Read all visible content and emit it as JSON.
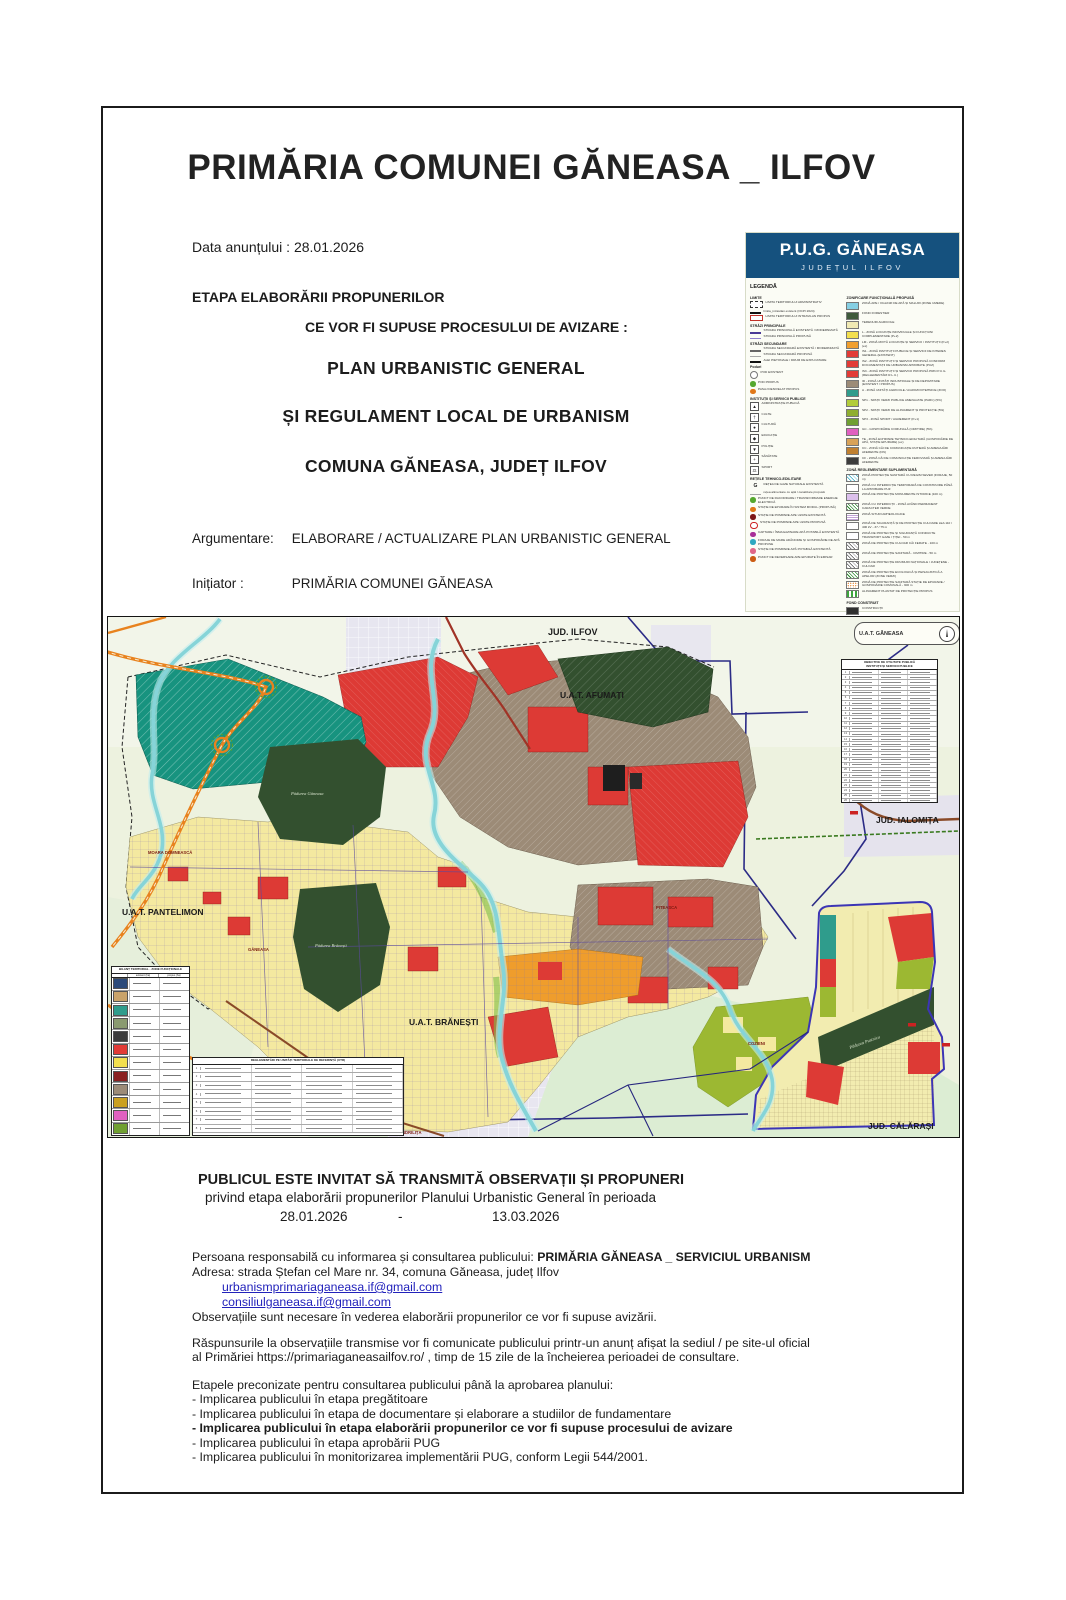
{
  "header": {
    "title": "PRIMĂRIA COMUNEI GĂNEASA _ ILFOV",
    "date_line": "Data anunțului : 28.01.2026",
    "stage_line1": "ETAPA ELABORĂRII PROPUNERILOR",
    "stage_line2": "CE VOR FI SUPUSE PROCESULUI DE AVIZARE :",
    "doc_title1": "PLAN URBANISTIC GENERAL",
    "doc_title2": "ȘI REGULAMENT LOCAL DE URBANISM",
    "doc_title3": "COMUNA GĂNEASA, JUDEȚ ILFOV",
    "argument_label": "Argumentare:",
    "argument_value": "ELABORARE / ACTUALIZARE PLAN URBANISTIC GENERAL",
    "initiator_label": "Inițiator :",
    "initiator_value": "PRIMĂRIA COMUNEI GĂNEASA"
  },
  "legend_panel": {
    "title": "P.U.G. GĂNEASA",
    "subtitle": "JUDEȚUL ILFOV",
    "heading": "LEGENDĂ",
    "header_color": "#15517e",
    "left_items": [
      {
        "h": "LIMITE"
      },
      {
        "sym": "dashbox",
        "glyph": "",
        "label": "LIMITA TERITORIULUI ADMINISTRATIV"
      },
      {
        "sym": "lineblack",
        "glyph": "",
        "label": "limita_intravilan existent (OCPI 2024)"
      },
      {
        "sym": "redbox",
        "glyph": "",
        "label": "LIMITA TERITORIULUI INTRAVILAN PROPUS"
      },
      {
        "h": "STRĂZI PRINCIPALE"
      },
      {
        "sym": "linepurple",
        "glyph": "",
        "label": "STRADA PRINCIPALĂ EXISTENTĂ / MODERNIZATĂ"
      },
      {
        "sym": "linepurple2",
        "glyph": "",
        "label": "STRADA PRINCIPALĂ PROPUSĂ"
      },
      {
        "h": "STRĂZI SECUNDARE"
      },
      {
        "sym": "linegray",
        "glyph": "",
        "label": "STRADA SECUNDARĂ EXISTENTĂ / MODERNIZATĂ"
      },
      {
        "sym": "linegray2",
        "glyph": "",
        "label": "STRADA SECUNDARĂ PROPUSĂ"
      },
      {
        "sym": "lineblack",
        "glyph": "",
        "label": "ALEI PIETONALE / DRUM DE EXPLOATARE"
      },
      {
        "h": "Poduri"
      },
      {
        "sym": "ringgray",
        "glyph": "",
        "label": "POD EXISTENT"
      },
      {
        "sym": "dgreen",
        "glyph": "",
        "label": "POD PROPUS"
      },
      {
        "sym": "dorange",
        "glyph": "",
        "label": "PASAJ DENIVELAT PROPUS"
      },
      {
        "h": "INSTITUȚII ȘI SERVICII PUBLICE"
      },
      {
        "sym": "symbox",
        "glyph": "▲",
        "label": "ADMINISTRAȚIE PUBLICĂ"
      },
      {
        "sym": "symbox",
        "glyph": "†",
        "label": "CULTE"
      },
      {
        "sym": "symbox",
        "glyph": "●",
        "label": "CULTURĂ"
      },
      {
        "sym": "symbox",
        "glyph": "◆",
        "label": "EDUCAȚIE"
      },
      {
        "sym": "symbox",
        "glyph": "▼",
        "label": "POLIȚIE"
      },
      {
        "sym": "symbox",
        "glyph": "+",
        "label": "SĂNĂTATE"
      },
      {
        "sym": "symbox",
        "glyph": "⚖",
        "label": "SPORT"
      },
      {
        "h": "REȚELE TEHNICO-EDILITARE"
      },
      {
        "sym": "gsym",
        "glyph": "G",
        "label": "REȚEA DE GAZE NATURALE EXISTENTĂ"
      },
      {
        "sym": "linegray2",
        "glyph": "",
        "label": "rețea alimentare cu apă / canalizare propusă"
      },
      {
        "sym": "dgreen",
        "glyph": "",
        "label": "PUNCT DE RACORDARE / TRANSFORMARE ENERGIE ELECTRICĂ"
      },
      {
        "sym": "dorange",
        "glyph": "",
        "label": "STAȚIE DE EPURARE ÎN SISTEM MODUL (PROPUSĂ)"
      },
      {
        "sym": "ddarkred",
        "glyph": "",
        "label": "STAȚIE DE POMPARE APE UZATE EXISTENTĂ"
      },
      {
        "sym": "dringred",
        "glyph": "",
        "label": "STAȚIE DE POMPARE APE UZATE PROPUSĂ"
      },
      {
        "sym": "dmagenta",
        "glyph": "",
        "label": "CAPTARE / ÎNMAGAZINARE APĂ POTABILĂ EXISTENTĂ"
      },
      {
        "sym": "dcyan",
        "glyph": "",
        "label": "FORAJE DE MARE ADÂNCIME ȘI GOSPODĂRIE DE APĂ PROPUSE"
      },
      {
        "sym": "dpink",
        "glyph": "",
        "label": "STAȚIE DE POMPARE APĂ POTABILĂ EXISTENTĂ"
      },
      {
        "sym": "dorange2",
        "glyph": "",
        "label": "PUNCT DE DEVERSARE APE EPURATE ÎN EMISAR"
      }
    ],
    "zoning_heading": "ZONIFICARE FUNCȚIONALĂ PROPUSĂ",
    "zoning_items": [
      {
        "color": "#86cfe3",
        "label": "ZONĂ APE / OGLINZI DE APĂ ȘI MALURI (ZONE UMEDE)"
      },
      {
        "color": "#3f5a3c",
        "label": "FOND FORESTIER"
      },
      {
        "color": "#f1eab4",
        "label": "TERENURI AGRICOLE"
      },
      {
        "color": "#f3df4e",
        "label": "L - ZONĂ LOCUINȚE INDIVIDUALE ȘI FUNCȚIUNI COMPLEMENTARE (P+2)"
      },
      {
        "color": "#f09f2e",
        "label": "LM - ZONĂ MIXTĂ LOCUINȚE ȘI SERVICII / INSTITUȚII (P+2) (ex)"
      },
      {
        "color": "#e23b36",
        "label": "IS1 - ZONĂ INSTITUȚII PUBLICE ȘI SERVICII DE INTERES GENERAL (EXISTENT)"
      },
      {
        "color": "#e23b36",
        "label": "IS2 - ZONĂ INSTITUȚII ȘI SERVICII PROPUSĂ CONFORM DOCUMENTAȚII DE URBANISM APROBATE (PUZ)"
      },
      {
        "color": "#e23b36",
        "label": "IS3 - ZONĂ INSTITUȚII ȘI SERVICII PROPUSĂ PRIN P.U.G. (REGLEMENTĂRI R.L.U.)"
      },
      {
        "color": "#9c8b77",
        "label": "ID - ZONĂ UNITĂȚI INDUSTRIALE ȘI DE DEPOZITARE (EXISTENT / PROPUS)"
      },
      {
        "color": "#2f9c8c",
        "label": "A - ZONĂ UNITĂȚI AGRICOLE / AGROZOOTEHNICE (ZOO)"
      },
      {
        "color": "#b2cc3a",
        "label": "SP1 - SPAȚII VERZI PUBLICE AMENAJATE (PARC) (5%)"
      },
      {
        "color": "#8fae2f",
        "label": "SP2 - SPAȚII VERZI DE ALINIAMENT ȘI PROTECȚIE (5%)"
      },
      {
        "color": "#70a032",
        "label": "SP3 - ZONĂ SPORT / AGREMENT (P+1)"
      },
      {
        "color": "#e060c0",
        "label": "GC - GOSPODĂRIE COMUNALĂ (CIMITIRE) (5%)"
      },
      {
        "color": "#d8a258",
        "label": "TE - ZONĂ ECHIPARE TEHNICO-EDILITARĂ (GOSPODĂRIE DE APĂ, STAȚIE EPURARE) (ex)"
      },
      {
        "color": "#c08030",
        "label": "CC - ZONĂ CĂI DE COMUNICAȚIE RUTIERĂ ȘI AMENAJĂRI AFERENTE (DN)"
      },
      {
        "color": "#3c3c3c",
        "label": "CF - ZONĂ CĂI DE COMUNICAȚIE FEROVIARĂ ȘI AMENAJĂRI AFERENTE"
      }
    ],
    "extra_heading": "ZONĂ REGLEMENTARE SUPLIMENTARĂ",
    "extra_items": [
      {
        "color": "#ffffff",
        "hatch": "hxc",
        "label": "ZONĂ PROTECȚIE SANITARĂ CU REGIM SEVER (FORAJE, 50 m)"
      },
      {
        "color": "#ffffff",
        "hatch": "",
        "label": "ZONĂ CU INTERDICȚIE TEMPORARĂ DE CONSTRUIRE PÂNĂ LA APROBARE PUZ"
      },
      {
        "color": "#dcc0ec",
        "hatch": "hxpl",
        "label": "ZONĂ DE PROTECȚIE MONUMENTE ISTORICE (100 m)"
      },
      {
        "color": "#ffffff",
        "hatch": "hxg",
        "label": "ZONĂ CU INTERDICȚII - ZONĂ AVÂND PERMANENT CARACTER VERDE"
      },
      {
        "color": "#ffffff",
        "hatch": "hxp",
        "label": "ZONĂ SITURI ARHEOLOGICE"
      },
      {
        "color": "#ffffff",
        "hatch": "",
        "label": "ZONĂ DE SIGURANȚĂ ȘI DE PROTECȚIE CULOARE LEA 110 / 400 kV - 37 / 75 m"
      },
      {
        "color": "#ffffff",
        "hatch": "",
        "label": "ZONĂ DE PROTECȚIE ȘI SIGURANȚĂ CONDUCTE TRANSPORT GAZE / ȚIȚEI - 50 m"
      },
      {
        "color": "#ffffff",
        "hatch": "hxd",
        "label": "ZONĂ DE PROTECȚIE CULOAR CĂI FERATE - 100 m"
      },
      {
        "color": "#ffffff",
        "hatch": "hxd",
        "label": "ZONĂ DE PROTECȚIE SANITARĂ - CIMITIRE - 50 m"
      },
      {
        "color": "#ffffff",
        "hatch": "hxd",
        "label": "ZONĂ DE PROTECȚIE DRUMURI NAȚIONALE / JUDEȚENE - CULOAR"
      },
      {
        "color": "#ffffff",
        "hatch": "hxg",
        "label": "ZONĂ DE PROTECȚIE ECOLOGICĂ ȘI PEISAGISTICĂ A APELOR (ZONE VERZI)"
      },
      {
        "color": "#ffffff",
        "hatch": "hxo",
        "label": "ZONĂ DE PROTECȚIE SANITARĂ STAȚIE DE EPURARE / GOSPODĂRIE COMUNALĂ - 300 m"
      },
      {
        "color": "#ffffff",
        "hatch": "hxgd",
        "label": "ALINIAMENT PLANTAT DE PROTECȚIE PROPUS"
      }
    ],
    "built_heading": "FOND CONSTRUIT",
    "built_items": [
      {
        "color": "#2f2f2f",
        "label": "CONSTRUCȚII"
      },
      {
        "color": "#3a35b0",
        "label": "ZONE / LOTURI CU DOCUMENTAȚII DE URBANISM APROBATE PENTRU LOCUINȚE (PUZ / PUD)"
      }
    ]
  },
  "map": {
    "labels": {
      "jud_ilfov": "JUD. ILFOV",
      "uat_afumati": "U.A.T. AFUMAȚI",
      "jud_ialomita": "JUD. IALOMIȚA",
      "uat_pantelimon": "U.A.T. PANTELIMON",
      "uat_branesti": "U.A.T. BRĂNEȘTI",
      "jud_calarasi": "JUD. CĂLĂRAȘI",
      "uat_ganeasa": "U.A.T. GĂNEASA",
      "forest_a": "Pădurea Găneasa",
      "forest_b": "Pădurea Brănești",
      "forest_se": "Pădurea Pustnicu",
      "village_moara": "MOARA DOMNEASCĂ",
      "village_ganeasa": "GĂNEASA",
      "village_piteasca": "PITEASCA",
      "village_cozieni": "COZIENI",
      "village_sindrilita": "ȘINDRILIȚA"
    },
    "right_table": {
      "title1": "OBIECTIVE DE UTILITATE PUBLICĂ",
      "title2": "INSTITUȚII ȘI SERVICII PUBLICE",
      "rows": [
        "1",
        "2",
        "3",
        "4",
        "5",
        "6",
        "7",
        "8",
        "9",
        "10",
        "11",
        "12",
        "13",
        "14",
        "15",
        "16",
        "17",
        "18",
        "19",
        "20",
        "21",
        "22",
        "23",
        "24",
        "25",
        "26",
        "27",
        "28"
      ]
    },
    "balance_table": {
      "title": "BILANȚ TERITORIAL - ZONE FUNCȚIONALE",
      "col1": "existent (ha)",
      "col2": "propus (ha)",
      "rows": [
        {
          "color": "#2b4a7a"
        },
        {
          "color": "#c9a36a"
        },
        {
          "color": "#2f9c8c"
        },
        {
          "color": "#8a9a70"
        },
        {
          "color": "#3c3c3c"
        },
        {
          "color": "#e23b36"
        },
        {
          "color": "#f3df4e"
        },
        {
          "color": "#8a2020"
        },
        {
          "color": "#9c8b77"
        },
        {
          "color": "#caa020"
        },
        {
          "color": "#e060c0"
        },
        {
          "color": "#70a032"
        }
      ]
    },
    "parcels_table": {
      "title": "REGLEMENTĂRI PE UNITĂȚI TERITORIALE DE REFERINȚĂ (UTR)",
      "rows": [
        "1",
        "2",
        "3",
        "4",
        "5",
        "6",
        "7",
        "8"
      ]
    }
  },
  "footer": {
    "heading": "PUBLICUL ESTE INVITAT SĂ TRANSMITĂ OBSERVAȚII ȘI PROPUNERI",
    "subheading": "privind etapa elaborării propunerilor Planului Urbanistic General în perioada",
    "period_start": "28.01.2026",
    "period_dash": "-",
    "period_end": "13.03.2026",
    "responsible_label": "Persoana responsabilă cu informarea și consultarea publicului: ",
    "responsible_value": "PRIMĂRIA GĂNEASA _ SERVICIUL URBANISM",
    "address": "Adresa:  strada Ștefan cel Mare nr. 34, comuna Găneasa, județ Ilfov",
    "email1": "urbanismprimariaganeasa.if@gmail.com",
    "email2": "consiliulganeasa.if@gmail.com",
    "observations": "Observațiile sunt necesare în vederea elaborării propunerilor ce vor fi supuse avizării.",
    "answers_line1": "Răspunsurile la observațiile transmise vor fi comunicate publicului printr-un anunț afișat la sediul / pe site-ul oficial",
    "answers_line2": "al Primăriei https://primariaganeasailfov.ro/ , timp de 15 zile de la încheierea perioadei de consultare.",
    "stages_intro": "Etapele preconizate pentru consultarea publicului până la aprobarea planului:",
    "stages": [
      {
        "text": "- Implicarea publicului în etapa pregătitoare",
        "cls": ""
      },
      {
        "text": "- Implicarea publicului în etapa de documentare și elaborare a studiilor de fundamentare",
        "cls": ""
      },
      {
        "text": "- Implicarea publicului în etapa elaborării propunerilor ce vor fi supuse procesului de avizare",
        "cls": "b"
      },
      {
        "text": "- Implicarea publicului în etapa aprobării PUG",
        "cls": ""
      },
      {
        "text": "- Implicarea publicului în monitorizarea implementării PUG, conform Legii 544/2001.",
        "cls": ""
      }
    ]
  }
}
